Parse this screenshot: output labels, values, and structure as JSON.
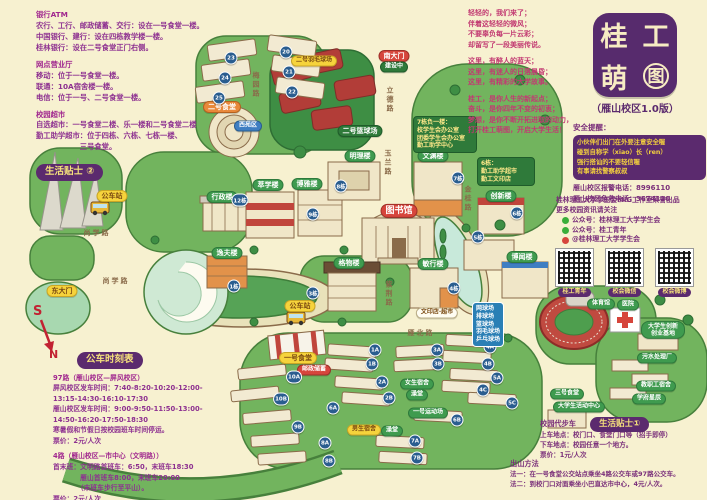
{
  "title": {
    "chars": [
      "桂",
      "工",
      "萌",
      "图"
    ],
    "subtitle": "（雁山校区1.0版）"
  },
  "colors": {
    "background": "#f7f1d0",
    "brand_purple": "#5b2a6e",
    "text_purple": "#8d3090",
    "poem_pink": "#c23a72",
    "map_green": "#72b45e",
    "accent_red": "#d6453c",
    "accent_yellow": "#f6d33c",
    "badge_blue": "#2a5d8f"
  },
  "tips2": {
    "badge": "生活贴士 ②",
    "sections": [
      {
        "h": "银行ATM",
        "lines": [
          "农行、工行、邮政储蓄、交行：设在一号食堂一楼。",
          "中国银行、建行：设在四栋教学楼一楼。",
          "桂林银行：设在二号食堂正门右侧。"
        ]
      },
      {
        "h": "网点营业厅",
        "lines": [
          "移动：位于一号食堂一楼。",
          "联通：10A宿舍楼一楼。",
          "电信：位于一号、二号食堂一楼。"
        ]
      },
      {
        "h": "校园超市",
        "lines": [
          "自选超市：一号食堂二楼、乐一楼和二号食堂二楼",
          "勤工助学超市：位于四栋、六栋、七栋一楼、",
          "　　　　　　三号食堂。"
        ]
      }
    ]
  },
  "poem": {
    "stanzas": [
      [
        "轻轻的，我们来了；",
        "伴着这轻轻的微风；",
        "不要辜负每一片云彩；",
        "却留写了一段美丽传说。"
      ],
      [
        "这里，有醉人的蓝天；",
        "这里，有迷人的日落晨昏；",
        "这里，有精彩的大学故事。"
      ],
      [
        "桂工，是你人生的新起点；",
        "奋斗，是你四年不变的初衷；",
        "梦想，是你不断开拓进取的动力，",
        "打开桂工萌图，开启大学生活！"
      ]
    ]
  },
  "safety": {
    "heading": "安全提醒：",
    "box_lines": [
      "小伙伴们出门在外要注意安全喔",
      "碰到自称学（xiao）长（ren）",
      "强行搭讪的不要轻信喔",
      "有事请找警察叔叔"
    ],
    "phones": [
      "雁山校区报警电话：8996110",
      "雁山校区急救电话：3674120"
    ]
  },
  "credits": {
    "produced_by": "桂林理工大学学生会MIG工作室荣誉出品",
    "follow": "更多校园资讯请关注",
    "accounts": [
      {
        "icon": "wechat-icon",
        "label": "公众号：桂林理工大学学生会"
      },
      {
        "icon": "wechat-icon",
        "label": "公众号：桂工青年"
      },
      {
        "icon": "weibo-icon",
        "label": "@桂林理工大学学生会"
      }
    ],
    "qr_labels": [
      "桂工青年",
      "校会微信",
      "校会微博"
    ]
  },
  "bus": {
    "badge": "公车时刻表",
    "lines": [
      {
        "t": "97路（雁山校区—屏风校区）",
        "b": true
      },
      {
        "t": "屏风校区发车时间：7:40-8:20-10:20-12:00-"
      },
      {
        "t": "13:15-14:30-16:10-17:30"
      },
      {
        "t": "雁山校区发车时间：9:00-9:50-11:50-13:00-"
      },
      {
        "t": "14:50-16:20-17:50-18:30"
      },
      {
        "t": "寒暑假和节假日按校园班车时间停运。"
      },
      {
        "t": "票价：2元/人次"
      },
      {
        "t": "",
        "sp": true
      },
      {
        "t": "4路（雁山校区—市中心（文明路））",
        "b": true
      },
      {
        "t": "首末班：文明路首班车：6:50，末班车18:30"
      },
      {
        "t": "　　　　雁山首班车8:00，末班车20:00"
      },
      {
        "t": "　　　　（末班车步行至平山）。"
      },
      {
        "t": "票价：2元/人次"
      }
    ]
  },
  "tips1": {
    "badge": "生活贴士①",
    "title": "校园代步车",
    "lines": [
      "上车地点：校门口、食堂门口等（招手即停）",
      "下车地点：校园任意一个地方。",
      "票价：1元/人次"
    ]
  },
  "exit": {
    "title": "出山方法",
    "lines": [
      "法一：在一号食堂公交站点乘坐4路公交车或97路公交车。",
      "法二：到校门口对面乘坐小巴直达市中心，4元/人次。"
    ]
  },
  "compass": {
    "south": "S",
    "north": "N"
  },
  "map": {
    "pills": [
      {
        "t": "南大门",
        "c": "red",
        "x": 394,
        "y": 56
      },
      {
        "t": "建设中",
        "c": "dark",
        "x": 394,
        "y": 67,
        "fs": 6
      },
      {
        "t": "二号篮球场",
        "c": "dark",
        "x": 360,
        "y": 131
      },
      {
        "t": "二号羽毛球场",
        "c": "yellow",
        "x": 314,
        "y": 61,
        "fs": 6
      },
      {
        "t": "二号食堂",
        "c": "orange",
        "x": 222,
        "y": 107
      },
      {
        "t": "西苑区",
        "c": "blue",
        "x": 248,
        "y": 126,
        "fs": 6
      },
      {
        "t": "公车站",
        "c": "yellow",
        "x": 112,
        "y": 196
      },
      {
        "t": "公车站",
        "c": "yellow",
        "x": 300,
        "y": 306
      },
      {
        "t": "东大门",
        "c": "yellow",
        "x": 62,
        "y": 291
      },
      {
        "t": "行政楼",
        "c": "green",
        "x": 222,
        "y": 197
      },
      {
        "t": "逸夫楼",
        "c": "green",
        "x": 227,
        "y": 253
      },
      {
        "t": "萃学楼",
        "c": "green",
        "x": 268,
        "y": 185
      },
      {
        "t": "博雅楼",
        "c": "green",
        "x": 307,
        "y": 184
      },
      {
        "t": "明理楼",
        "c": "green",
        "x": 360,
        "y": 156
      },
      {
        "t": "文渊楼",
        "c": "green",
        "x": 433,
        "y": 156
      },
      {
        "t": "图书馆",
        "c": "red",
        "x": 399,
        "y": 211,
        "fs": 9
      },
      {
        "t": "创新楼",
        "c": "green",
        "x": 501,
        "y": 196
      },
      {
        "t": "博闻楼",
        "c": "green",
        "x": 522,
        "y": 257
      },
      {
        "t": "敏行楼",
        "c": "green",
        "x": 433,
        "y": 264
      },
      {
        "t": "格物楼",
        "c": "green",
        "x": 349,
        "y": 263
      },
      {
        "t": "文印店·超市",
        "c": "white",
        "x": 437,
        "y": 313,
        "fs": 6
      },
      {
        "t": "一号食堂",
        "c": "yellow",
        "x": 298,
        "y": 358
      },
      {
        "t": "邮政储蓄",
        "c": "redsm",
        "x": 314,
        "y": 370,
        "fs": 6
      },
      {
        "t": "女生宿舍",
        "c": "green",
        "x": 417,
        "y": 384,
        "fs": 6
      },
      {
        "t": "澡堂",
        "c": "green",
        "x": 417,
        "y": 395,
        "fs": 6
      },
      {
        "t": "男生宿舍",
        "c": "yellow",
        "x": 364,
        "y": 430,
        "fs": 6
      },
      {
        "t": "澡堂",
        "c": "green",
        "x": 392,
        "y": 431,
        "fs": 6
      },
      {
        "t": "一号运动场",
        "c": "green",
        "x": 428,
        "y": 413,
        "fs": 6
      },
      {
        "t": "体育馆",
        "c": "green",
        "x": 601,
        "y": 304,
        "fs": 6
      },
      {
        "t": "医院",
        "c": "green",
        "x": 628,
        "y": 305,
        "fs": 6
      },
      {
        "t": "大学生创新创业基地",
        "c": "green wide",
        "x": 663,
        "y": 330,
        "fs": 6
      },
      {
        "t": "污水处理厂",
        "c": "green",
        "x": 657,
        "y": 358,
        "fs": 6
      },
      {
        "t": "教职工宿舍",
        "c": "green",
        "x": 656,
        "y": 386,
        "fs": 6
      },
      {
        "t": "学府星辰",
        "c": "green",
        "x": 649,
        "y": 399,
        "fs": 6
      },
      {
        "t": "三号食堂",
        "c": "green",
        "x": 567,
        "y": 394,
        "fs": 6
      },
      {
        "t": "大学生活动中心",
        "c": "green",
        "x": 579,
        "y": 407,
        "fs": 6
      }
    ],
    "badges": [
      {
        "t": "20",
        "x": 286,
        "y": 52
      },
      {
        "t": "21",
        "x": 289,
        "y": 72
      },
      {
        "t": "22",
        "x": 292,
        "y": 92
      },
      {
        "t": "23",
        "x": 231,
        "y": 58
      },
      {
        "t": "24",
        "x": 225,
        "y": 78
      },
      {
        "t": "25",
        "x": 219,
        "y": 98
      },
      {
        "t": "12栋",
        "x": 240,
        "y": 200
      },
      {
        "t": "9栋",
        "x": 313,
        "y": 214
      },
      {
        "t": "8栋",
        "x": 341,
        "y": 186
      },
      {
        "t": "7栋",
        "x": 458,
        "y": 178
      },
      {
        "t": "6栋",
        "x": 517,
        "y": 213
      },
      {
        "t": "5栋",
        "x": 478,
        "y": 237
      },
      {
        "t": "4栋",
        "x": 454,
        "y": 288
      },
      {
        "t": "3栋",
        "x": 313,
        "y": 293
      },
      {
        "t": "1栋",
        "x": 234,
        "y": 286
      },
      {
        "t": "1A",
        "x": 375,
        "y": 350
      },
      {
        "t": "1B",
        "x": 372,
        "y": 364
      },
      {
        "t": "2A",
        "x": 382,
        "y": 382
      },
      {
        "t": "2B",
        "x": 389,
        "y": 398
      },
      {
        "t": "3A",
        "x": 437,
        "y": 350
      },
      {
        "t": "3B",
        "x": 438,
        "y": 364
      },
      {
        "t": "4A",
        "x": 490,
        "y": 347
      },
      {
        "t": "4B",
        "x": 488,
        "y": 364
      },
      {
        "t": "4C",
        "x": 483,
        "y": 390
      },
      {
        "t": "5A",
        "x": 497,
        "y": 378
      },
      {
        "t": "5C",
        "x": 512,
        "y": 403
      },
      {
        "t": "6A",
        "x": 333,
        "y": 408
      },
      {
        "t": "6B",
        "x": 457,
        "y": 420
      },
      {
        "t": "7A",
        "x": 415,
        "y": 441
      },
      {
        "t": "7B",
        "x": 417,
        "y": 458
      },
      {
        "t": "8A",
        "x": 325,
        "y": 443
      },
      {
        "t": "8B",
        "x": 329,
        "y": 461
      },
      {
        "t": "9B",
        "x": 298,
        "y": 427
      },
      {
        "t": "10A",
        "x": 294,
        "y": 377
      },
      {
        "t": "10B",
        "x": 281,
        "y": 399
      }
    ],
    "roads": [
      {
        "t": "立德路",
        "x": 390,
        "y": 100,
        "v": true
      },
      {
        "t": "玉兰路",
        "x": 388,
        "y": 163,
        "v": true
      },
      {
        "t": "金桂路",
        "x": 468,
        "y": 199,
        "v": true
      },
      {
        "t": "紫荆路",
        "x": 389,
        "y": 294,
        "v": true
      },
      {
        "t": "梅园路",
        "x": 256,
        "y": 85,
        "v": true
      },
      {
        "t": "尚学路",
        "x": 97,
        "y": 233
      },
      {
        "t": "尚学路",
        "x": 116,
        "y": 281
      },
      {
        "t": "雁北路",
        "x": 421,
        "y": 333
      }
    ],
    "boxes": [
      {
        "x": 413,
        "y": 116,
        "w": 64,
        "lines": [
          "7栋负一楼：",
          "校学生会办公室",
          "团委学生会办公室",
          "勤工助学中心"
        ]
      },
      {
        "x": 477,
        "y": 157,
        "w": 58,
        "lines": [
          "6栋：",
          "勤工助学超市",
          "勤工文印店"
        ]
      },
      {
        "x": 472,
        "y": 302,
        "w": 32,
        "blue": true,
        "lines": [
          "网球场",
          "排球场",
          "篮球场",
          "羽毛球场",
          "乒乓球场"
        ]
      }
    ]
  }
}
